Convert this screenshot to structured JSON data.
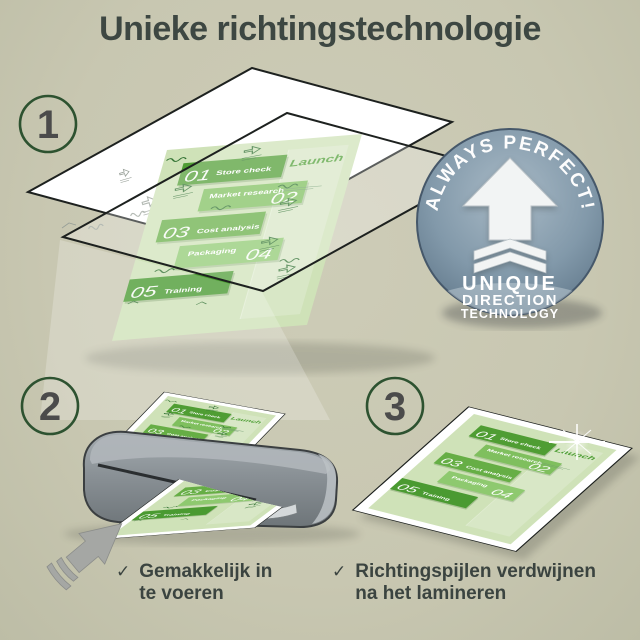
{
  "title": "Unieke richtingstechnologie",
  "step_numbers": [
    "1",
    "2",
    "3"
  ],
  "badge": {
    "arc_text": "ALWAYS PERFECT!",
    "lines": [
      "UNIQUE",
      "DIRECTION",
      "TECHNOLOGY"
    ]
  },
  "doc": {
    "steps": [
      {
        "num": "01",
        "label": "Store check"
      },
      {
        "num": "02",
        "label": "Market research"
      },
      {
        "num": "03",
        "label": "Cost analysis"
      },
      {
        "num": "04",
        "label": "Packaging"
      },
      {
        "num": "05",
        "label": "Training"
      }
    ],
    "launch": "Launch"
  },
  "benefits": [
    {
      "icon": "✓",
      "text": "Gemakkelijk in te voeren"
    },
    {
      "icon": "✓",
      "text": "Richtingspijlen verdwijnen na het lamineren"
    }
  ],
  "colors": {
    "background": "#c9c8b2",
    "title_text": "#3d4742",
    "step_ring": "#2d5230",
    "step_number": "#4b4b4b",
    "doc_green_dark": "#4f9d33",
    "doc_green_mid": "#69b049",
    "doc_green_light": "#8ec96f",
    "doc_page": "#cfe2b8",
    "badge_steel": "#7b8fa0",
    "machine_gray": "#8a9196",
    "benefit_text": "#3b4440",
    "white": "#ffffff"
  }
}
